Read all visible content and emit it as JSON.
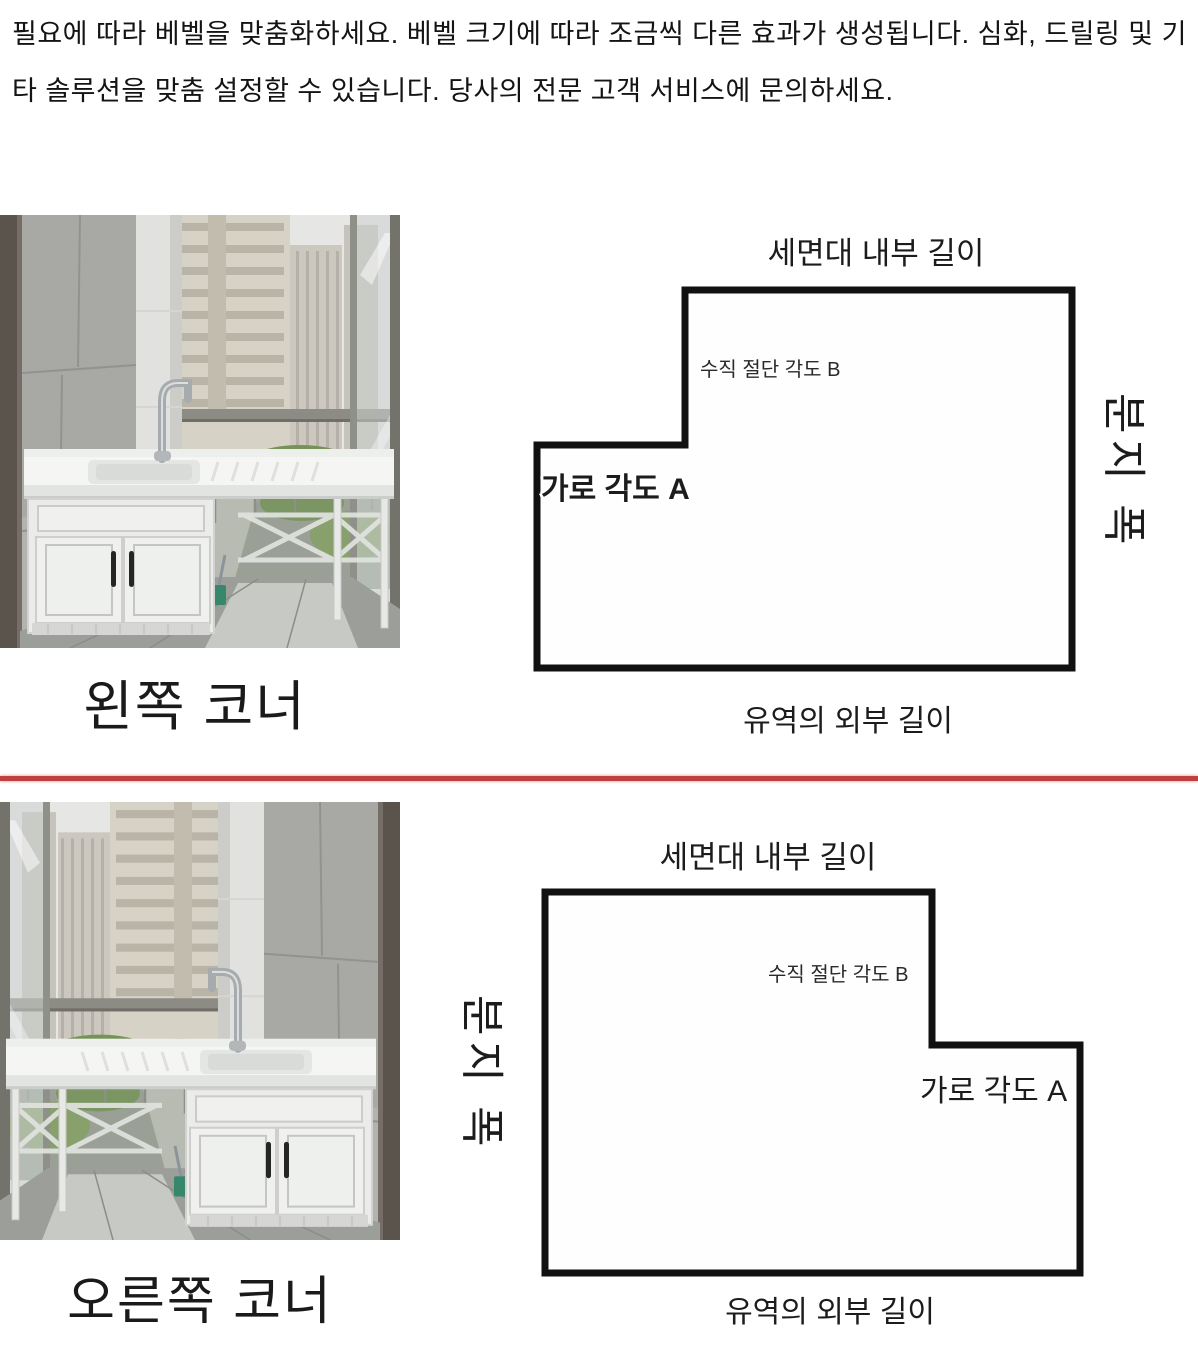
{
  "intro": {
    "text": "필요에 따라 베벨을 맞춤화하세요. 베벨 크기에 따라 조금씩 다른 효과가 생성됩니다. 심화, 드릴링 및 기타 솔루션을 맞춤 설정할 수 있습니다. 당사의 전문 고객 서비스에 문의하세요."
  },
  "divider": {
    "color": "#c04040"
  },
  "diagram_stroke_color": "#111111",
  "sections": [
    {
      "photo_caption": "왼쪽 코너",
      "diagram": {
        "top_label": "세면대 내부 길이",
        "vertical_cut_angle_label": "수직 절단 각도 B",
        "horizontal_angle_label": "가로 각도 A",
        "basin_width_label": "분지 폭",
        "bottom_label": "유역의 외부 길이"
      }
    },
    {
      "photo_caption": "오른쪽 코너",
      "diagram": {
        "top_label": "세면대 내부 길이",
        "vertical_cut_angle_label": "수직 절단 각도 B",
        "horizontal_angle_label": "가로 각도 A",
        "basin_width_label": "분지 폭",
        "bottom_label": "유역의 외부 길이"
      }
    }
  ]
}
